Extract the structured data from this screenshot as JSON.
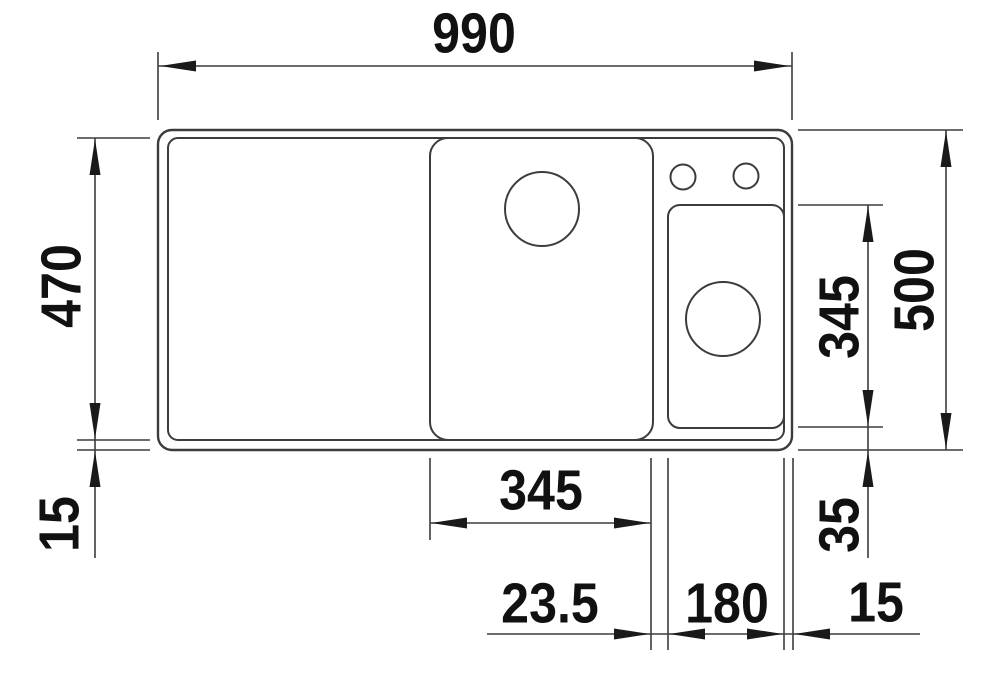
{
  "drawing": {
    "description": "Technical plan-view drawing of a kitchen sink with a drainboard, one main bowl, a half bowl, two tap holes and dimension lines",
    "line_color": "#3c3c3c",
    "text_color": "#111111",
    "background": "#ffffff"
  },
  "labels": {
    "overall_width": "990",
    "inner_depth": "470",
    "front_rim": "15",
    "overall_depth": "500",
    "half_bowl_depth": "345",
    "bottom_rim": "35",
    "main_bowl_width": "345",
    "divider_width": "23.5",
    "half_bowl_width": "180",
    "side_rim": "15"
  }
}
